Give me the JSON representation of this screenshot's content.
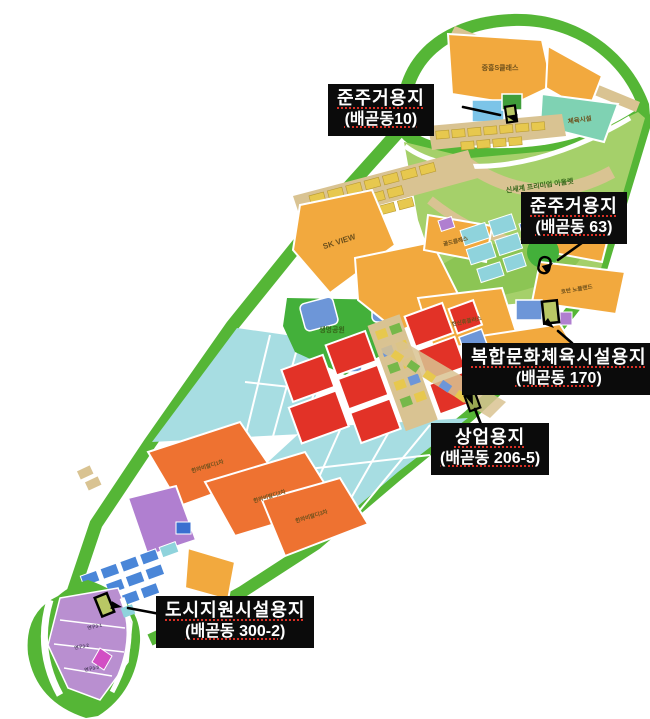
{
  "page": {
    "width": 650,
    "height": 719,
    "background": "#ffffff",
    "description_type": "land-use-plan-map"
  },
  "palette": {
    "boundary_green": "#55b636",
    "park_green": "#43b03a",
    "golf_green": "#a5d06a",
    "fairway_green": "#8cc554",
    "residential_orange": "#f2a93e",
    "apartment_orange": "#ee7231",
    "commercial_red": "#e23227",
    "school_cyan": "#a7dde2",
    "block_teal": "#8fd3dc",
    "block_blue": "#6d96d8",
    "support_blue": "#4a86d8",
    "sky_blue": "#7cc4e8",
    "sports_teal": "#7fd2b3",
    "research_purple": "#b98fd0",
    "purple_block": "#b07fd0",
    "magenta": "#d24ec4",
    "road_tan": "#d9c392",
    "rowhouse_yellow": "#e7c84e",
    "target_olive": "#b9c765",
    "callout_bg": "#0b0b0b",
    "callout_text": "#ffffff",
    "underline_red": "#d93025",
    "arrow_black": "#000000"
  },
  "map_labels": {
    "jungheung_s_class": "중흥S클래스",
    "sports_facility": "체육시설",
    "shinsegae_outlet": "신세계 프리미엄 아울렛",
    "sk_view": "SK VIEW",
    "gold_class": "골드클래스",
    "hoban_nobleland": "호반 노블랜드",
    "life_park": "생명공원",
    "hanshin_hueplus": "한신휴플러스",
    "halla_vivaldi_1": "한라비발디1차",
    "halla_vivaldi_2": "한라비발디2차",
    "halla_vivaldi_3": "한라비발디3차",
    "research_3_1": "연구3-1",
    "research_3_2": "연구3-2",
    "research_3_3": "연구3-3"
  },
  "callouts": [
    {
      "name": "semi-residential-baegot-10",
      "line1": "준주거용지",
      "line2": "(배곧동10)"
    },
    {
      "name": "semi-residential-baegot-63",
      "line1": "준주거용지",
      "line2": "(배곧동 63)"
    },
    {
      "name": "culture-sports-baegot-170",
      "line1": "복합문화체육시설용지",
      "line2": "(배곧동 170)"
    },
    {
      "name": "commercial-baegot-206-5",
      "line1": "상업용지",
      "line2": "(배곧동 206-5)"
    },
    {
      "name": "city-support-baegot-300-2",
      "line1": "도시지원시설용지",
      "line2": "(배곧동 300-2)"
    }
  ]
}
